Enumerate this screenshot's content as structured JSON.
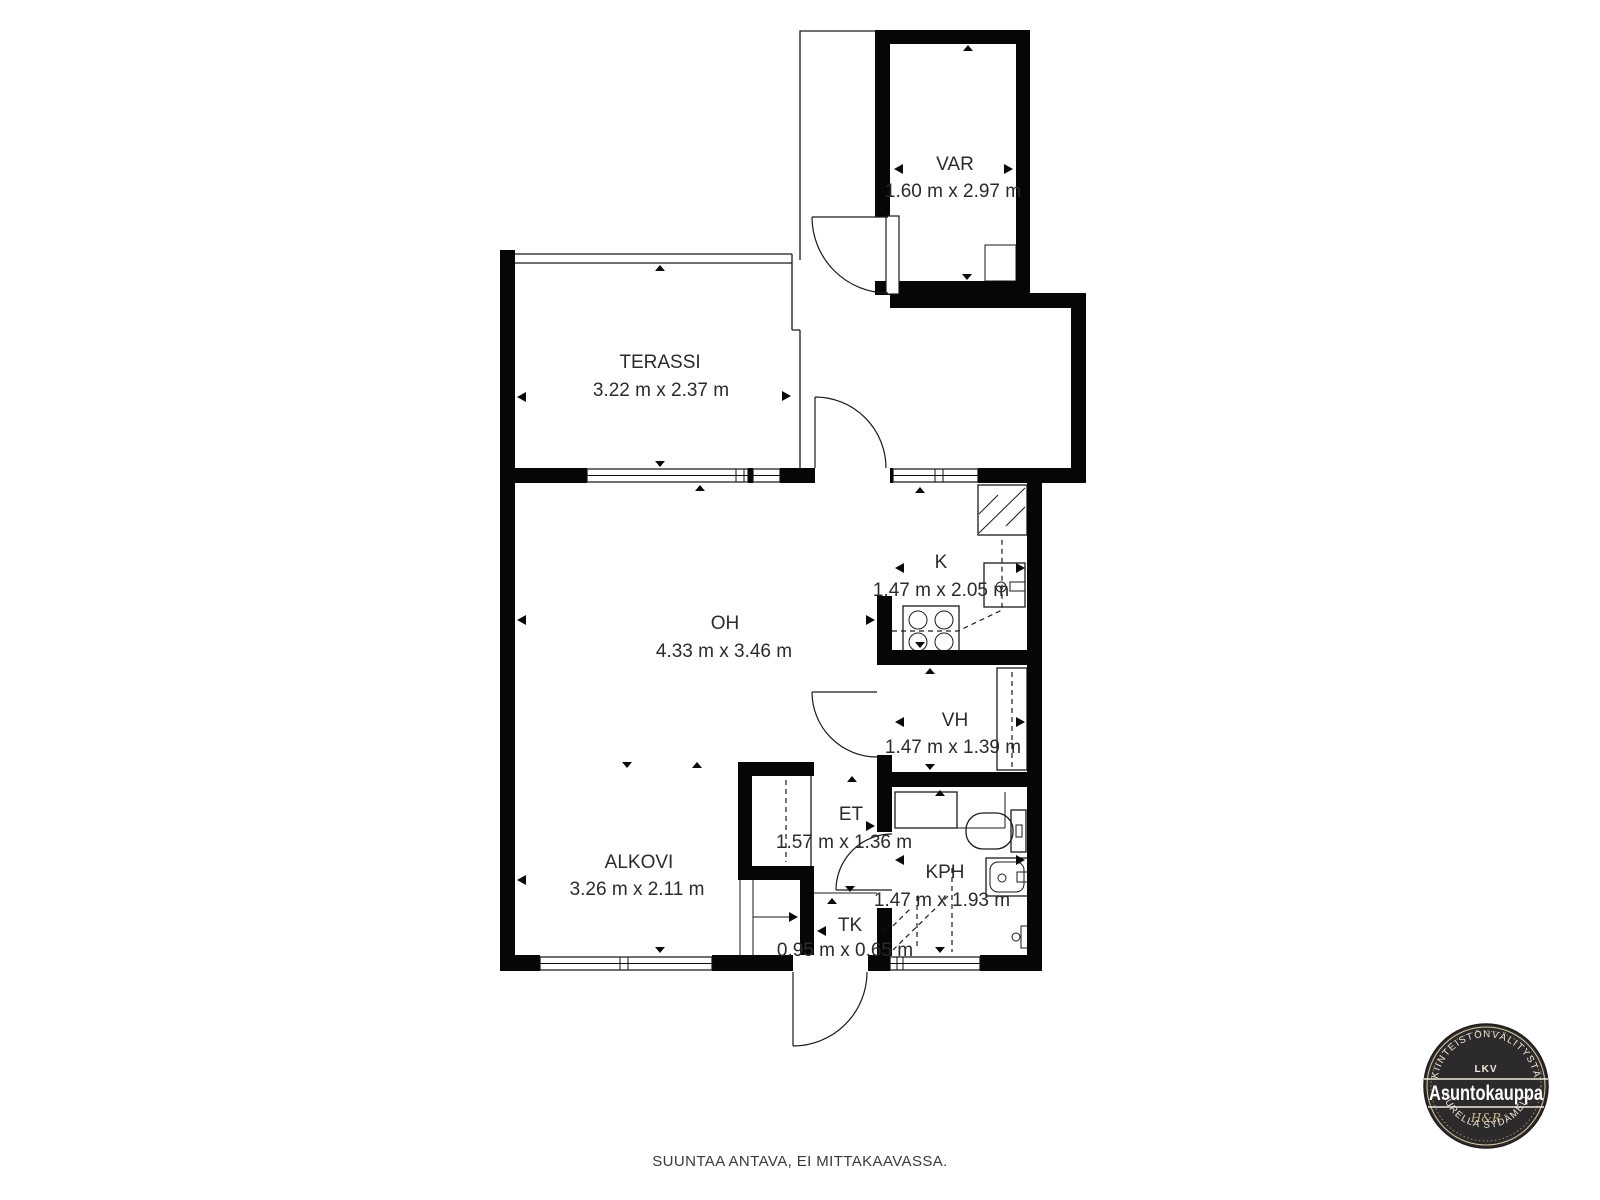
{
  "rooms": {
    "var": {
      "label": "VAR",
      "dims": "1.60 m x 2.97 m"
    },
    "terassi": {
      "label": "TERASSI",
      "dims": "3.22 m x 2.37 m"
    },
    "oh": {
      "label": "OH",
      "dims": "4.33 m x 3.46 m"
    },
    "k": {
      "label": "K",
      "dims": "1.47 m x 2.05 m"
    },
    "vh": {
      "label": "VH",
      "dims": "1.47 m x 1.39 m"
    },
    "et": {
      "label": "ET",
      "dims": "1.57 m x 1.36 m"
    },
    "alkovi": {
      "label": "ALKOVI",
      "dims": "3.26 m x 2.11 m"
    },
    "kph": {
      "label": "KPH",
      "dims": "1.47 m x 1.93 m"
    },
    "tk": {
      "label": "TK",
      "dims": "0.95 m x 0.65 m"
    }
  },
  "footer": {
    "disclaimer": "SUUNTAA ANTAVA, EI MITTAKAAVASSA."
  },
  "logo": {
    "top_arc": "KIINTEISTÖNVÄLITYSTÄ",
    "lkv": "LKV",
    "name": "Asuntokauppa",
    "monogram": "H&R",
    "bottom_arc": "SUURELLA SYDÄMELLÄ",
    "bg_color": "#2d2a2b",
    "accent_color": "#cdb88e",
    "text_color": "#efe9db"
  }
}
